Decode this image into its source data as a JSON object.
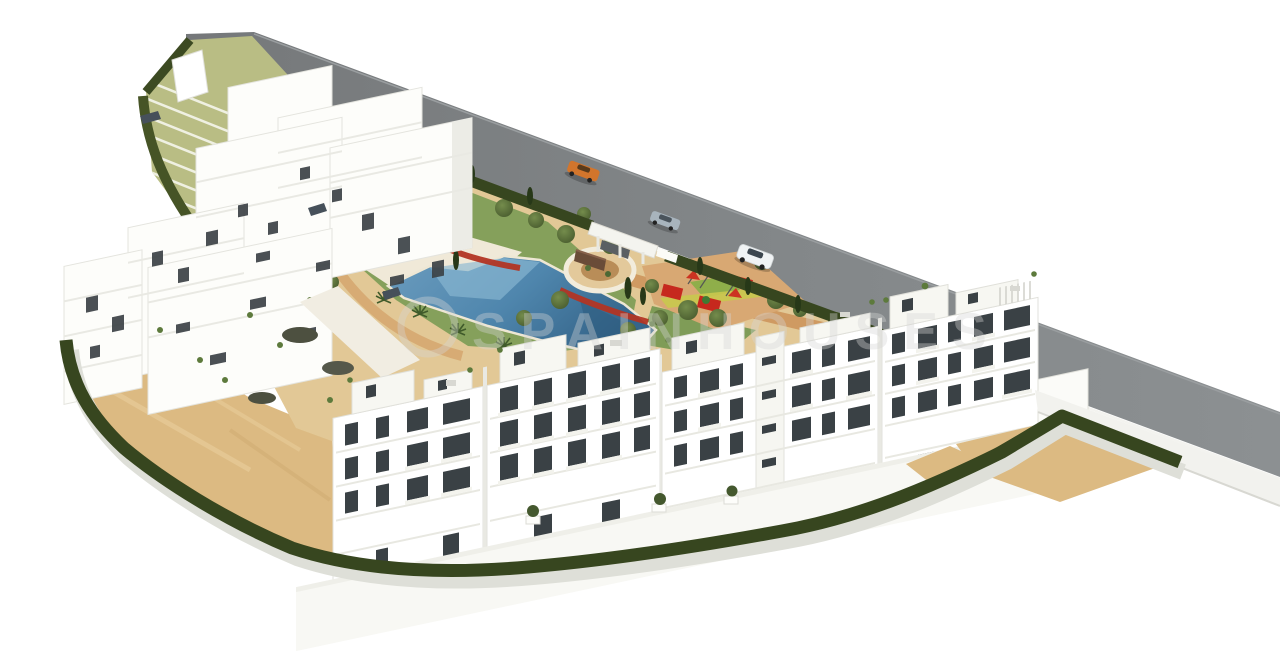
{
  "meta": {
    "title": "Aerial 3D render of new-build residential complex",
    "type": "architectural-rendering",
    "canvas": {
      "width": 1280,
      "height": 666
    }
  },
  "watermark": {
    "text": "SPAINHOUSES",
    "logo": "circle-outline",
    "color": "rgba(214,214,214,0.38)"
  },
  "scene": {
    "description": "Bird's-eye 3D visualization of a white Mediterranean apartment development: hillside apartment cluster on the left, four front apartment blocks, communal garden with swimming pool, circular plaza, playground, access road with three cars, perimeter hedge and sand-coloured terrain.",
    "colors": {
      "background": "#ffffff",
      "road": "#7d8183",
      "building_white": "#fdfdfa",
      "building_shadow": "#e9e9e3",
      "window": "#3a4145",
      "hedge": "#37461f",
      "lawn": "#85a05b",
      "pool": "#4f86ad",
      "path_terracotta": "#cf9a62",
      "ground_tan": "#e2c896",
      "sand": "#dcba82",
      "playground_red": "#c6281e",
      "car_orange": "#d2752c",
      "car_silver": "#a8b4bd",
      "car_white": "#f0f3f4"
    },
    "elements": {
      "buildings": [
        "hillside-apartment-cluster",
        "front-block-a",
        "front-block-b",
        "front-block-c",
        "front-block-d"
      ],
      "amenities": [
        "swimming-pool",
        "kids-pool",
        "lawn-garden",
        "circular-plaza",
        "playground",
        "terraced-steps",
        "entrance-gate",
        "roof-terraces"
      ],
      "vehicles": [
        {
          "type": "sports-car",
          "color": "orange"
        },
        {
          "type": "sedan",
          "color": "silver"
        },
        {
          "type": "suv",
          "color": "white"
        }
      ],
      "vegetation": [
        "perimeter-hedge",
        "road-hedge",
        "palm-trees",
        "olive-trees",
        "cypress-trees",
        "red-flower-beds"
      ]
    }
  }
}
